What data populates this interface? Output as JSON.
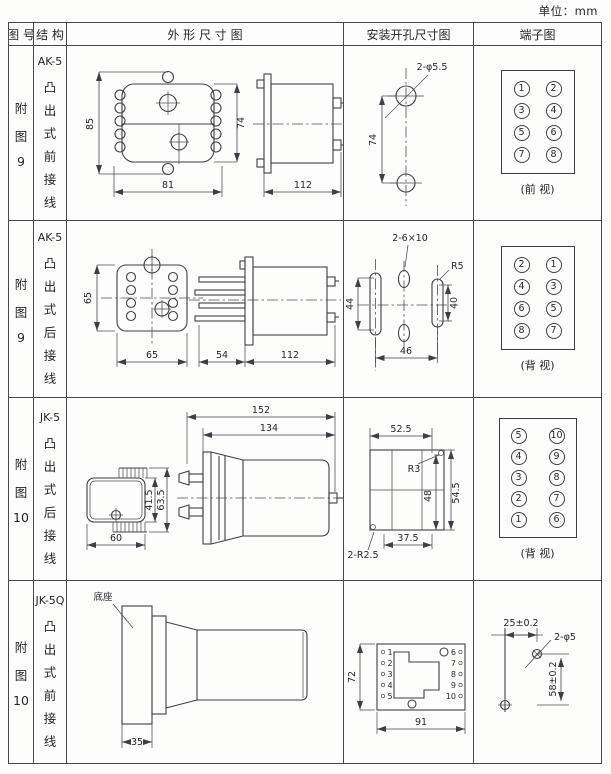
{
  "unit": "单位：mm",
  "header": {
    "figure": "图 号",
    "structure": "结 构",
    "outline": "外 形 尺 寸 图",
    "mounting": "安装开孔尺寸图",
    "terminal": "端子图"
  },
  "colors": {
    "line": "#3c4046",
    "text": "#23272c",
    "background": "#fdfdfc"
  },
  "rows": [
    {
      "figure": [
        "附",
        "图",
        "9"
      ],
      "model": "AK-5",
      "structure": [
        "凸",
        "出",
        "式",
        "前",
        "接",
        "线"
      ],
      "outline": {
        "front_height": "85",
        "body_height": "74",
        "width": "81",
        "side_length": "112"
      },
      "mounting": {
        "holes_label": "2-φ5.5",
        "vertical": "74"
      },
      "terminal": {
        "cells": [
          "1",
          "2",
          "3",
          "4",
          "5",
          "6",
          "7",
          "8"
        ],
        "view": "(前 视)"
      }
    },
    {
      "figure": [
        "附",
        "图",
        "9"
      ],
      "model": "AK-5",
      "structure": [
        "凸",
        "出",
        "式",
        "后",
        "接",
        "线"
      ],
      "outline": {
        "front_height": "65",
        "front_width": "65",
        "pin_length": "54",
        "side_length": "112"
      },
      "mounting": {
        "slots_label": "2-6×10",
        "radius_label": "R5",
        "left": "44",
        "right": "40",
        "bottom": "46"
      },
      "terminal": {
        "cells": [
          "2",
          "1",
          "4",
          "3",
          "6",
          "5",
          "8",
          "7"
        ],
        "view": "(背 视)"
      }
    },
    {
      "figure": [
        "附",
        "图",
        "10"
      ],
      "model": "JK-5",
      "structure": [
        "凸",
        "出",
        "式",
        "后",
        "接",
        "线"
      ],
      "outline": {
        "overall_length": "152",
        "body_length": "134",
        "front_width": "60",
        "front_height": "41.5",
        "overall_height": "63.5"
      },
      "mounting": {
        "top": "52.5",
        "radius_label": "R3",
        "height1": "48",
        "height2": "54.5",
        "bottom": "37.5",
        "corner_label": "2-R2.5"
      },
      "terminal": {
        "cells": [
          "5",
          "10",
          "4",
          "9",
          "3",
          "8",
          "2",
          "7",
          "1",
          "6"
        ],
        "view": "(背 视)"
      }
    },
    {
      "figure": [
        "附",
        "图",
        "10"
      ],
      "model": "JK-5Q",
      "structure": [
        "凸",
        "出",
        "式",
        "前",
        "接",
        "线"
      ],
      "outline": {
        "base_label": "底座",
        "base_width": "35"
      },
      "mounting": {
        "height": "72",
        "width": "91",
        "left_terminals": [
          "1",
          "2",
          "3",
          "4",
          "5"
        ],
        "right_terminals": [
          "6",
          "7",
          "8",
          "9",
          "10"
        ]
      },
      "drill": {
        "horizontal": "25±0.2",
        "holes_label": "2-φ5",
        "vertical": "58±0.2"
      }
    }
  ]
}
